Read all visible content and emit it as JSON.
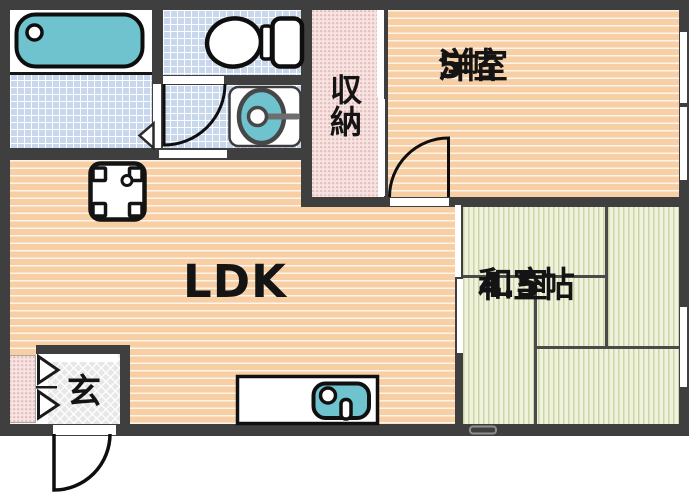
{
  "floorplan": {
    "rooms": {
      "ldk": {
        "label": "LDK"
      },
      "western_room": {
        "label": "洋室",
        "size": "5帖"
      },
      "japanese_room": {
        "label": "和室",
        "size": "4.5帖"
      },
      "storage": {
        "label": "収納"
      },
      "entrance": {
        "label": "玄"
      }
    },
    "fixtures": [
      "bathtub",
      "toilet",
      "washbasin",
      "washing-machine",
      "kitchen-sink"
    ],
    "colors": {
      "wall": "#3f3f3f",
      "wood_floor": "#f8cfa4",
      "tile_floor": "#c9d7ec",
      "tatami_floor": "#f0f2dd",
      "fixture_water": "#6fc3cf",
      "storage_floor": "#f7e4e2",
      "entrance_floor": "#e7e7e7"
    }
  }
}
